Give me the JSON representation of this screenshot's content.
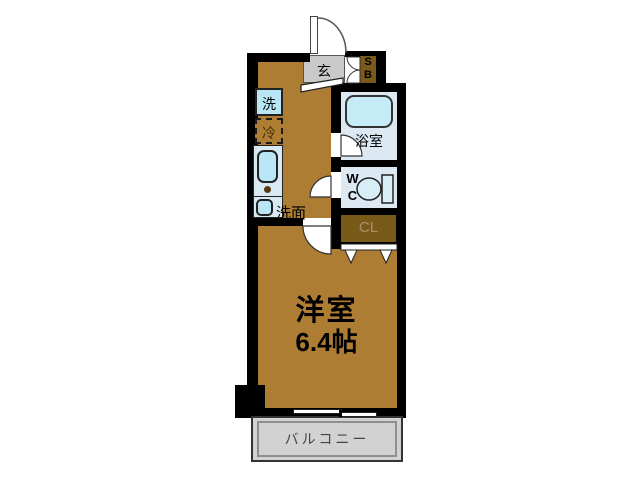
{
  "plan": {
    "rooms": {
      "entrance": {
        "label": "玄"
      },
      "shoe_box": {
        "letters": [
          "S",
          "B"
        ]
      },
      "washing_machine": {
        "label": "洗"
      },
      "refrigerator": {
        "label": "冷"
      },
      "bathroom": {
        "label": "浴室"
      },
      "toilet": {
        "letters": [
          "W",
          "C"
        ]
      },
      "washstand": {
        "label": "洗面"
      },
      "closet": {
        "label": "CL"
      },
      "western_room": {
        "name": "洋室",
        "size": "6.4帖"
      },
      "balcony": {
        "label": "バルコニー"
      }
    },
    "colors": {
      "wall": "#000000",
      "room_floor": "#ad7d33",
      "dark_wood": "#7a5a18",
      "wet_area": "#dce9f2",
      "fixture_cyan": "#b9e6f5",
      "entrance_gray": "#c9c9c9",
      "balcony_gray": "#d2d2d2",
      "closet_text": "#a5946b"
    }
  }
}
